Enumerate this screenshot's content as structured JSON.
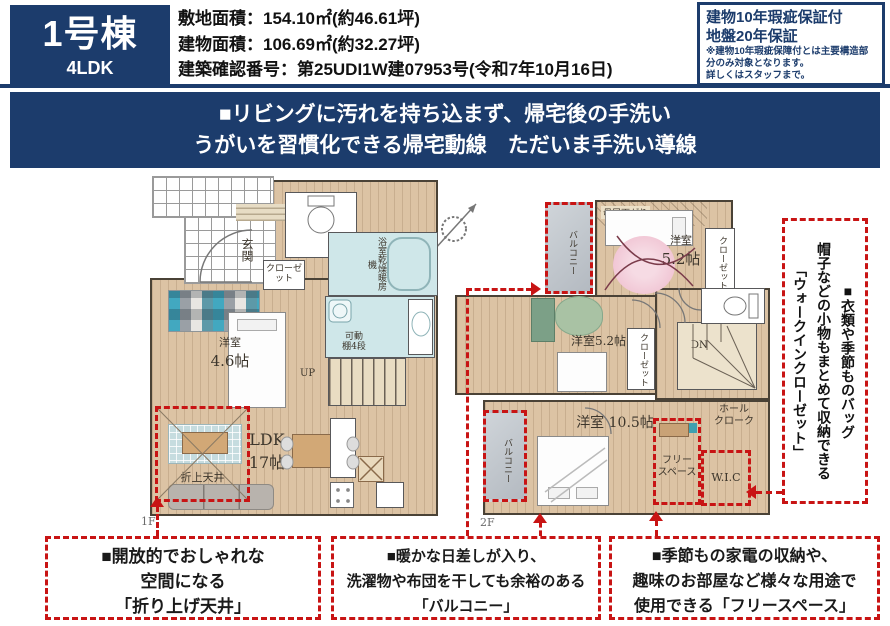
{
  "colors": {
    "navy": "#1c3c6c",
    "red": "#c81414",
    "floor": "#dcc3a4",
    "wet": "#cfe7e9",
    "balcony": "#c2c8ce"
  },
  "header": {
    "unit_name": "1号棟",
    "unit_type": "4LDK",
    "specs": [
      "敷地面積：154.10㎡(約46.61坪)",
      "建物面積：106.69㎡(約32.27坪)",
      "建築確認番号：第25UDI1W建07953号(令和7年10月16日)"
    ],
    "warranty": {
      "title1": "建物10年瑕疵保証付",
      "title2": "地盤20年保証",
      "note1": "※建物10年瑕疵保障付とは主要構造部分のみ対象となります。",
      "note2": "詳しくはスタッフまで。"
    }
  },
  "banner": {
    "line1": "■リビングに汚れを持ち込まず、帰宅後の手洗い",
    "line2": "うがいを習慣化できる帰宅動線　ただいま手洗い導線"
  },
  "floor1": {
    "label": "1F",
    "genkan": "玄関",
    "closet": "クローゼット",
    "room_name": "洋室",
    "room_size": "4.6帖",
    "bath_unit": "浴室乾燥暖房機",
    "shelf_1": "可動",
    "shelf_2": "棚4段",
    "up": "UP",
    "ldk_name": "LDK",
    "ldk_size": "17帖",
    "ceiling": "折上天井"
  },
  "floor2": {
    "label": "2F",
    "balcony": "バルコニー",
    "moyasagari": "母屋下がり",
    "room_a_name": "洋室",
    "room_a_size": "5.2帖",
    "room_b": "洋室5.2帖",
    "closet": "クローゼット",
    "dn": "DN",
    "room_c": "洋室 10.5帖",
    "hall_cloak_1": "ホール",
    "hall_cloak_2": "クローク",
    "free_space_1": "フリー",
    "free_space_2": "スペース",
    "wic": "W.I.C"
  },
  "side_note": {
    "line1": "■衣類や季節ものバッグ",
    "line2": "帽子などの小物もまとめて収納できる",
    "line3": "「ウォークインクローゼット」"
  },
  "callouts": [
    {
      "lines": [
        "■開放的でおしゃれな",
        "空間になる",
        "「折り上げ天井」"
      ]
    },
    {
      "lines": [
        "■暖かな日差しが入り、",
        "洗濯物や布団を干しても余裕のある",
        "「バルコニー」"
      ]
    },
    {
      "lines": [
        "■季節もの家電の収納や、",
        "趣味のお部屋など様々な用途で",
        "使用できる「フリースペース」"
      ]
    }
  ]
}
